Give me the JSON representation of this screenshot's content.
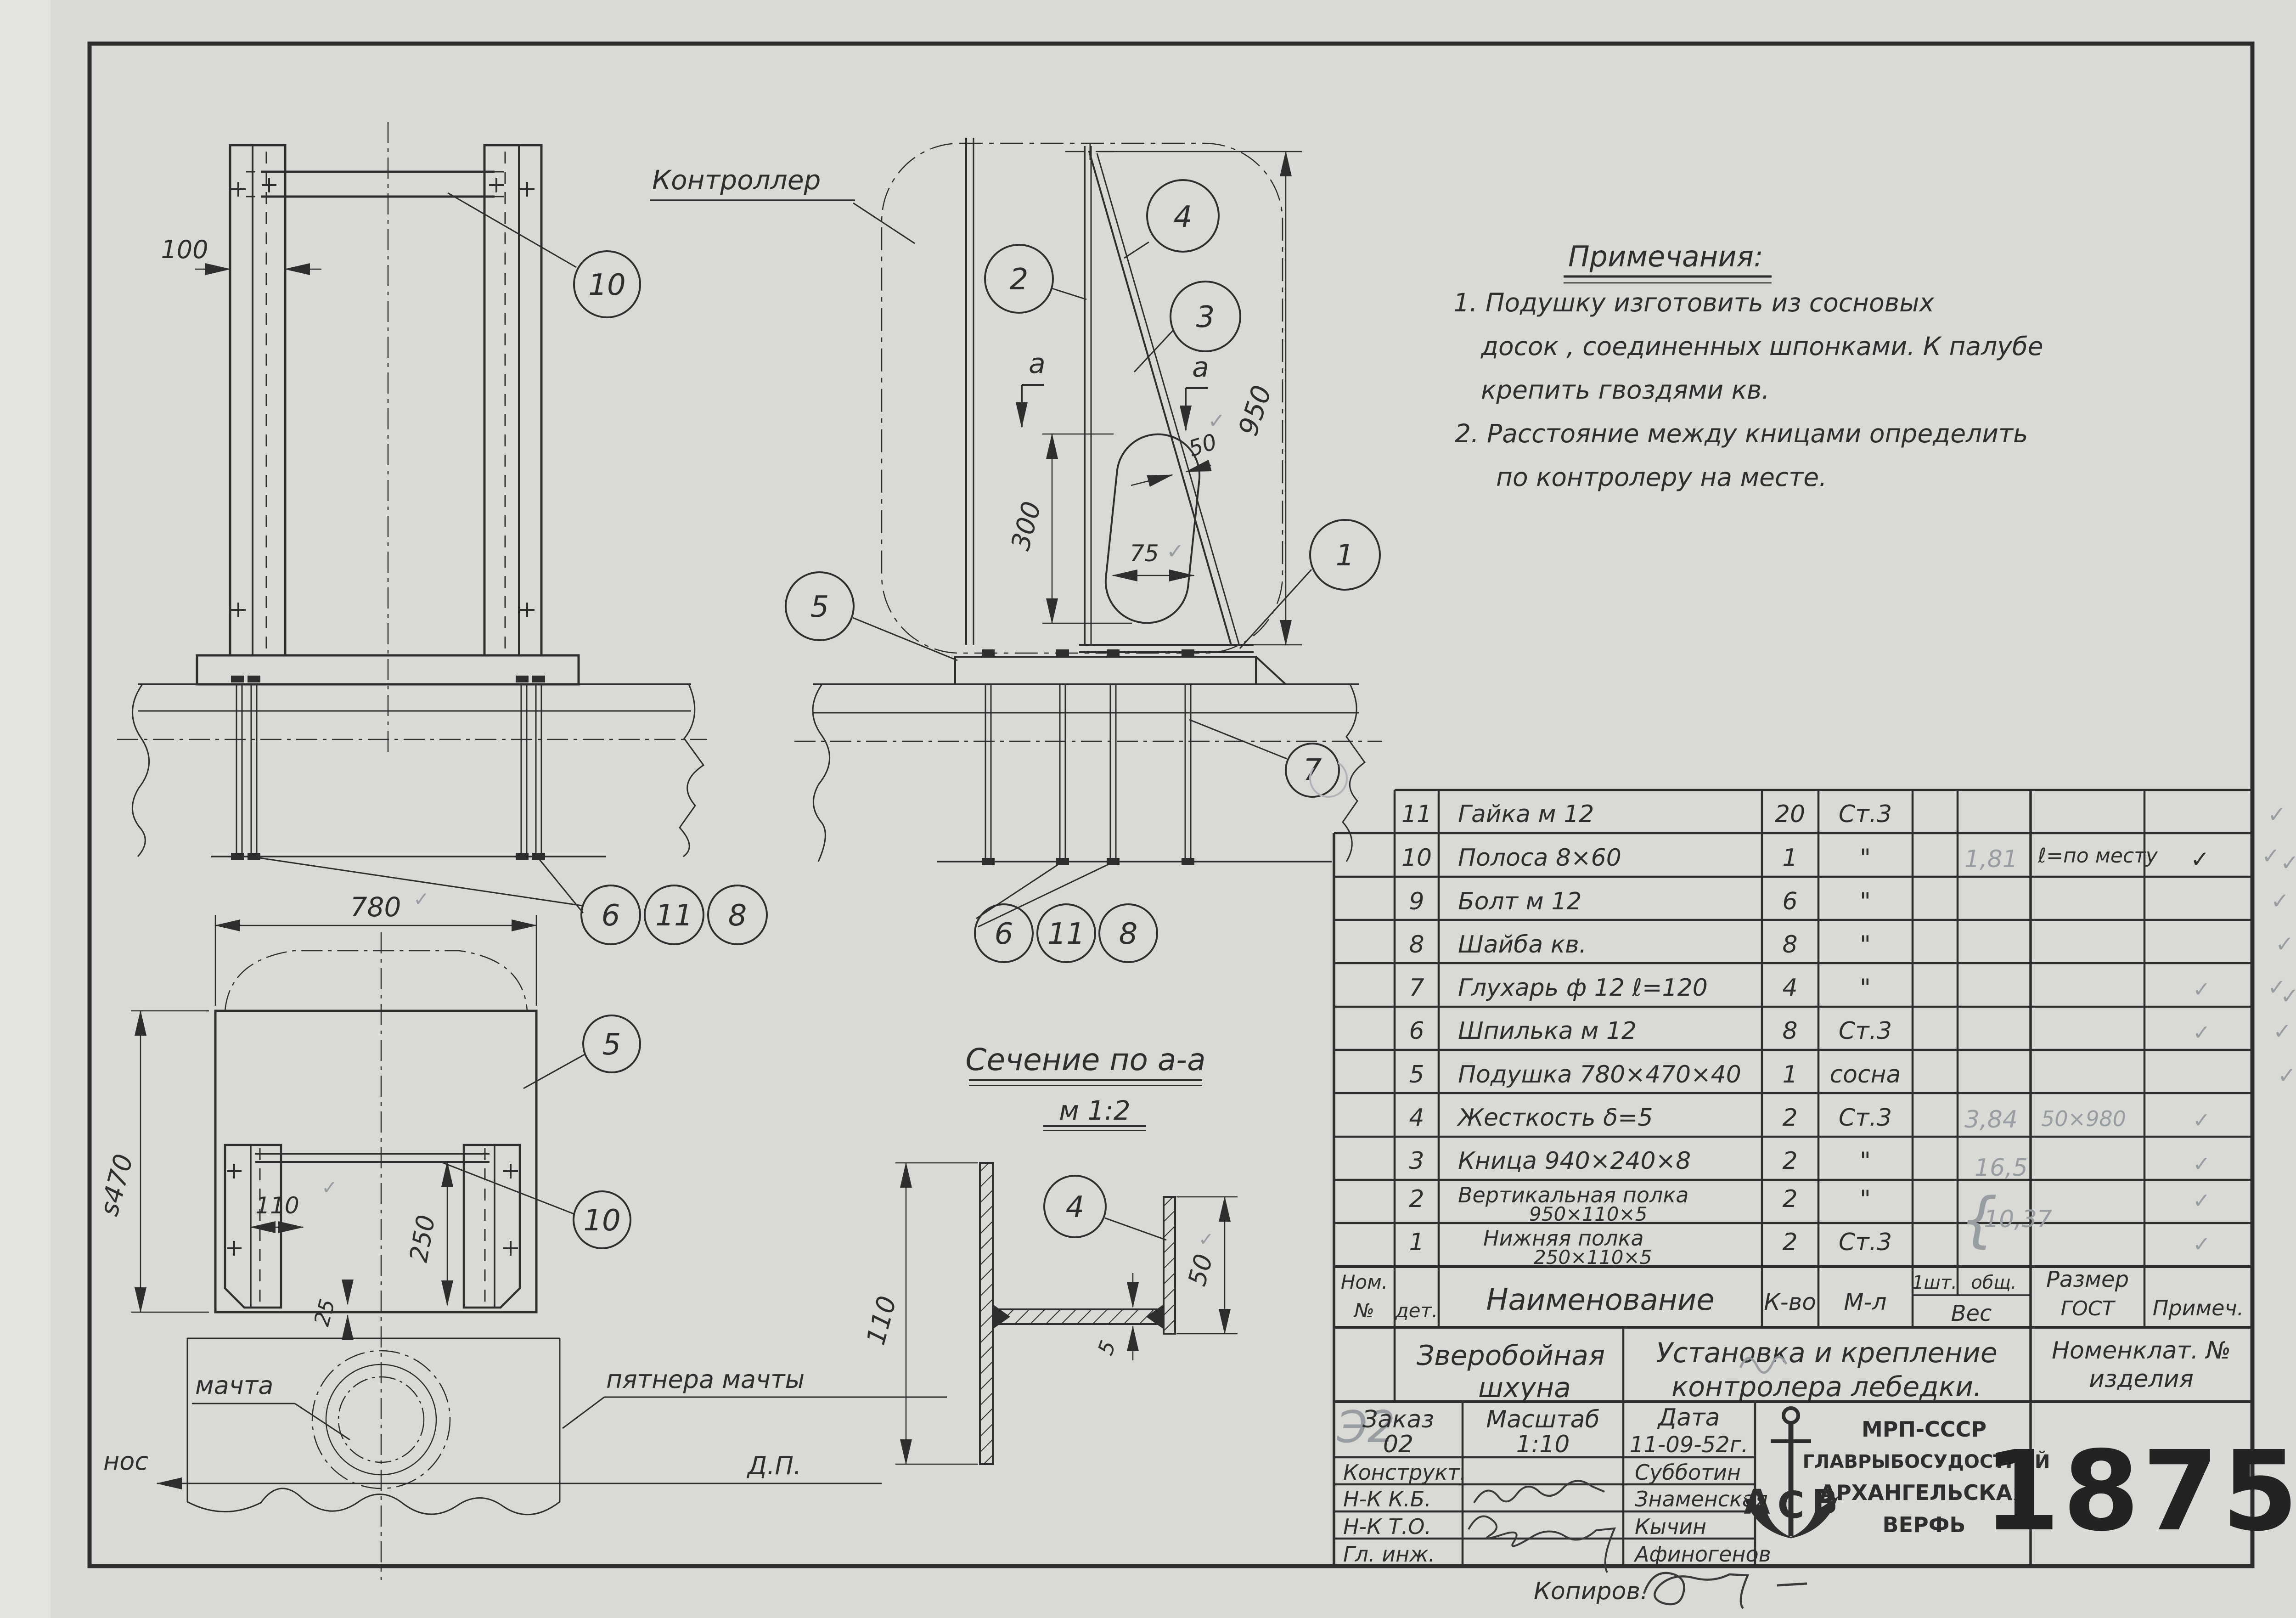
{
  "sheet": {
    "number": "1875"
  },
  "marks": {
    "check": "✓"
  },
  "notes": {
    "title": "Примечания:",
    "lines": [
      "1. Подушку изготовить из сосновых",
      "досок , соединенных шпонками. К палубе",
      "крепить гвоздями кв.",
      "2. Расстояние между кницами определить",
      "по контролеру на месте."
    ]
  },
  "labels": {
    "controller": "Контроллер",
    "section_title": "Сечение по а-а",
    "section_scale": "м 1:2",
    "mast": "мачта",
    "mast_step": "пятнера мачты",
    "bow": "нос",
    "centerplane": "Д.П.",
    "copier": "Копиров."
  },
  "dims": {
    "front_width": "100",
    "side_height": "950",
    "slot_height": "300",
    "stiffener_width": "50",
    "slot_width": "75",
    "plan_width": "780",
    "plan_depth": "s470",
    "leg_offset": "110",
    "legs_span": "250",
    "edge_offset": "25",
    "sec_height": "110",
    "sec_flange": "50",
    "sec_web": "5",
    "section_mark": "а"
  },
  "callouts": {
    "n1": "1",
    "n2": "2",
    "n3": "3",
    "n4": "4",
    "n5": "5",
    "n6": "6",
    "n7": "7",
    "n8": "8",
    "n10": "10",
    "n11": "11"
  },
  "parts_table": {
    "headers": {
      "nom": "Ном.",
      "no": "№",
      "det": "дет.",
      "name": "Наименование",
      "qty": "К-во",
      "mat": "М-л",
      "w1": "1шт.",
      "w2": "общ.",
      "weight": "Вес",
      "size": "Размер",
      "gost": "ГОСТ",
      "note": "Примеч."
    },
    "rows": [
      {
        "num": "11",
        "name": "Гайка м 12",
        "qty": "20",
        "mat": "Ст.3"
      },
      {
        "num": "10",
        "name": "Полоса 8×60",
        "qty": "1",
        "mat": "\"",
        "weight": "1,81",
        "size": "ℓ=по месту",
        "note": "✓"
      },
      {
        "num": "9",
        "name": "Болт м 12",
        "qty": "6",
        "mat": "\""
      },
      {
        "num": "8",
        "name": "Шайба кв.",
        "qty": "8",
        "mat": "\""
      },
      {
        "num": "7",
        "name": "Глухарь ф 12 ℓ=120",
        "qty": "4",
        "mat": "\"",
        "note": "✓"
      },
      {
        "num": "6",
        "name": "Шпилька м 12",
        "qty": "8",
        "mat": "Ст.3",
        "note": "✓"
      },
      {
        "num": "5",
        "name": "Подушка 780×470×40",
        "qty": "1",
        "mat": "сосна"
      },
      {
        "num": "4",
        "name": "Жесткость δ=5",
        "qty": "2",
        "mat": "Ст.3",
        "weight": "3,84",
        "size": "50×980",
        "note": "✓"
      },
      {
        "num": "3",
        "name": "Кница 940×240×8",
        "qty": "2",
        "mat": "\"",
        "weight": "16,5",
        "note": "✓"
      },
      {
        "num": "2",
        "name": "Вертикальная полка",
        "name2": "950×110×5",
        "qty": "2",
        "mat": "\"",
        "note": "✓"
      },
      {
        "num": "1",
        "name": "Нижняя полка",
        "name2": "250×110×5",
        "qty": "2",
        "mat": "Ст.3",
        "note": "✓"
      }
    ],
    "brace_weight": "10,37"
  },
  "title_block": {
    "pencil_code": "Э2",
    "project_line1": "Зверобойная",
    "project_line2": "шхуна",
    "title_line1": "Установка и крепление",
    "title_line2": "контролера лебедки.",
    "nomen_line1": "Номенклат. №",
    "nomen_line2": "изделия",
    "order_label": "Заказ",
    "order_value": "02",
    "scale_label": "Масштаб",
    "scale_value": "1:10",
    "date_label": "Дата",
    "date_value": "11-09-52г.",
    "org_line1": "МРП-СССР",
    "org_line2": "ГЛАВРЫБОСУДОСТРОЙ",
    "org_line3": "АРХАНГЕЛЬСКАЯ",
    "org_line4": "ВЕРФЬ",
    "logo_a": "А",
    "logo_c": "С",
    "logo_b": "В",
    "number": "1875",
    "roles": [
      {
        "label": "Конструкт.",
        "name": "Субботин"
      },
      {
        "label": "Н-К К.Б.",
        "name": "Знаменская"
      },
      {
        "label": "Н-К Т.О.",
        "name": "Кычин"
      },
      {
        "label": "Гл. инж.",
        "name": "Афиногенов"
      }
    ]
  }
}
